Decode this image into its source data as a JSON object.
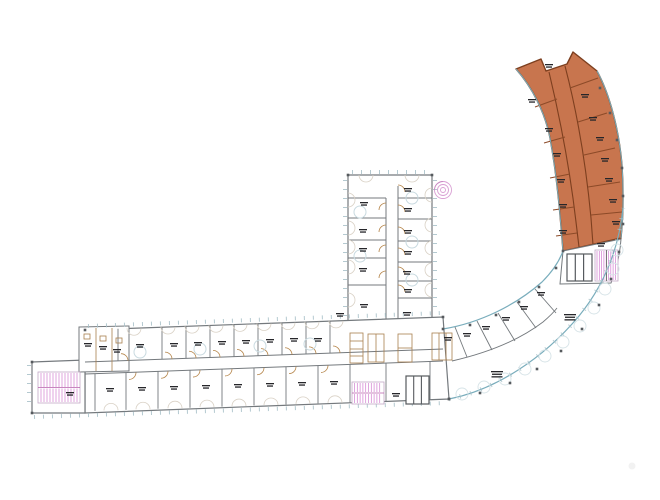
{
  "page": {
    "kind": "architectural-floor-plan",
    "description": "CAD line drawing of a curved L-shaped building floor plan; upper-right curved wing highlighted in orange",
    "background": "#ffffff"
  },
  "colors": {
    "wall": "#74797d",
    "wall_dark": "#565a5e",
    "glazing": "#79adbc",
    "glazing_tick": "#a7c0c8",
    "highlight_fill": "#c8754e",
    "highlight_wall": "#7d3f1f",
    "highlight_partition": "#8c4a28",
    "stair": "#d27fd0",
    "stair_frame": "#c3a8c6",
    "door": "#b5854a",
    "sanitary": "#a97f4e",
    "label": "#26262a",
    "furniture": "#c9dae0",
    "swing": "#d9d1c5",
    "scallop": "#d6e3e7",
    "spiral": "#d9a0d4"
  },
  "zones": {
    "highlighted": {
      "name": "curved-upper-wing",
      "selected": true
    },
    "wings": [
      "bottom-wing",
      "vertical-wing",
      "curved-hall-wing"
    ]
  },
  "room_labels": {
    "bottom_wing_top_row": [
      [
        140,
        344
      ],
      [
        174,
        343
      ],
      [
        198,
        342
      ],
      [
        222,
        341
      ],
      [
        246,
        340
      ],
      [
        270,
        339
      ],
      [
        294,
        338
      ],
      [
        318,
        338
      ]
    ],
    "bottom_wing_annex_rooms": [
      [
        88,
        343
      ],
      [
        103,
        346
      ],
      [
        117,
        349
      ],
      [
        70,
        392
      ]
    ],
    "bottom_wing_bottom_row": [
      [
        110,
        388
      ],
      [
        142,
        387
      ],
      [
        174,
        386
      ],
      [
        206,
        385
      ],
      [
        238,
        384
      ],
      [
        270,
        383
      ],
      [
        302,
        382
      ],
      [
        334,
        381
      ],
      [
        396,
        393
      ]
    ],
    "vertical_wing_left_col": [
      [
        364,
        202
      ],
      [
        363,
        229
      ],
      [
        363,
        248
      ],
      [
        363,
        268
      ],
      [
        364,
        304
      ]
    ],
    "vertical_wing_right_col": [
      [
        408,
        188
      ],
      [
        408,
        208
      ],
      [
        408,
        230
      ],
      [
        408,
        251
      ],
      [
        407,
        271
      ],
      [
        408,
        289
      ],
      [
        407,
        312
      ]
    ],
    "orange_inner_row": [
      [
        532,
        99
      ],
      [
        549,
        128
      ],
      [
        557,
        153
      ],
      [
        561,
        179
      ],
      [
        563,
        204
      ],
      [
        563,
        230
      ]
    ],
    "orange_outer_row": [
      [
        585,
        94
      ],
      [
        593,
        117
      ],
      [
        600,
        137
      ],
      [
        605,
        158
      ],
      [
        609,
        178
      ],
      [
        613,
        199
      ],
      [
        616,
        221
      ],
      [
        601,
        243
      ]
    ],
    "orange_top": [
      [
        549,
        64
      ]
    ],
    "hall_small_rooms": [
      [
        448,
        337
      ],
      [
        467,
        333
      ],
      [
        486,
        326
      ],
      [
        506,
        317
      ],
      [
        524,
        306
      ],
      [
        541,
        292
      ]
    ],
    "hall_open_space_big": [
      [
        570,
        314
      ],
      [
        497,
        371
      ]
    ],
    "junction": [
      [
        340,
        313
      ]
    ]
  }
}
